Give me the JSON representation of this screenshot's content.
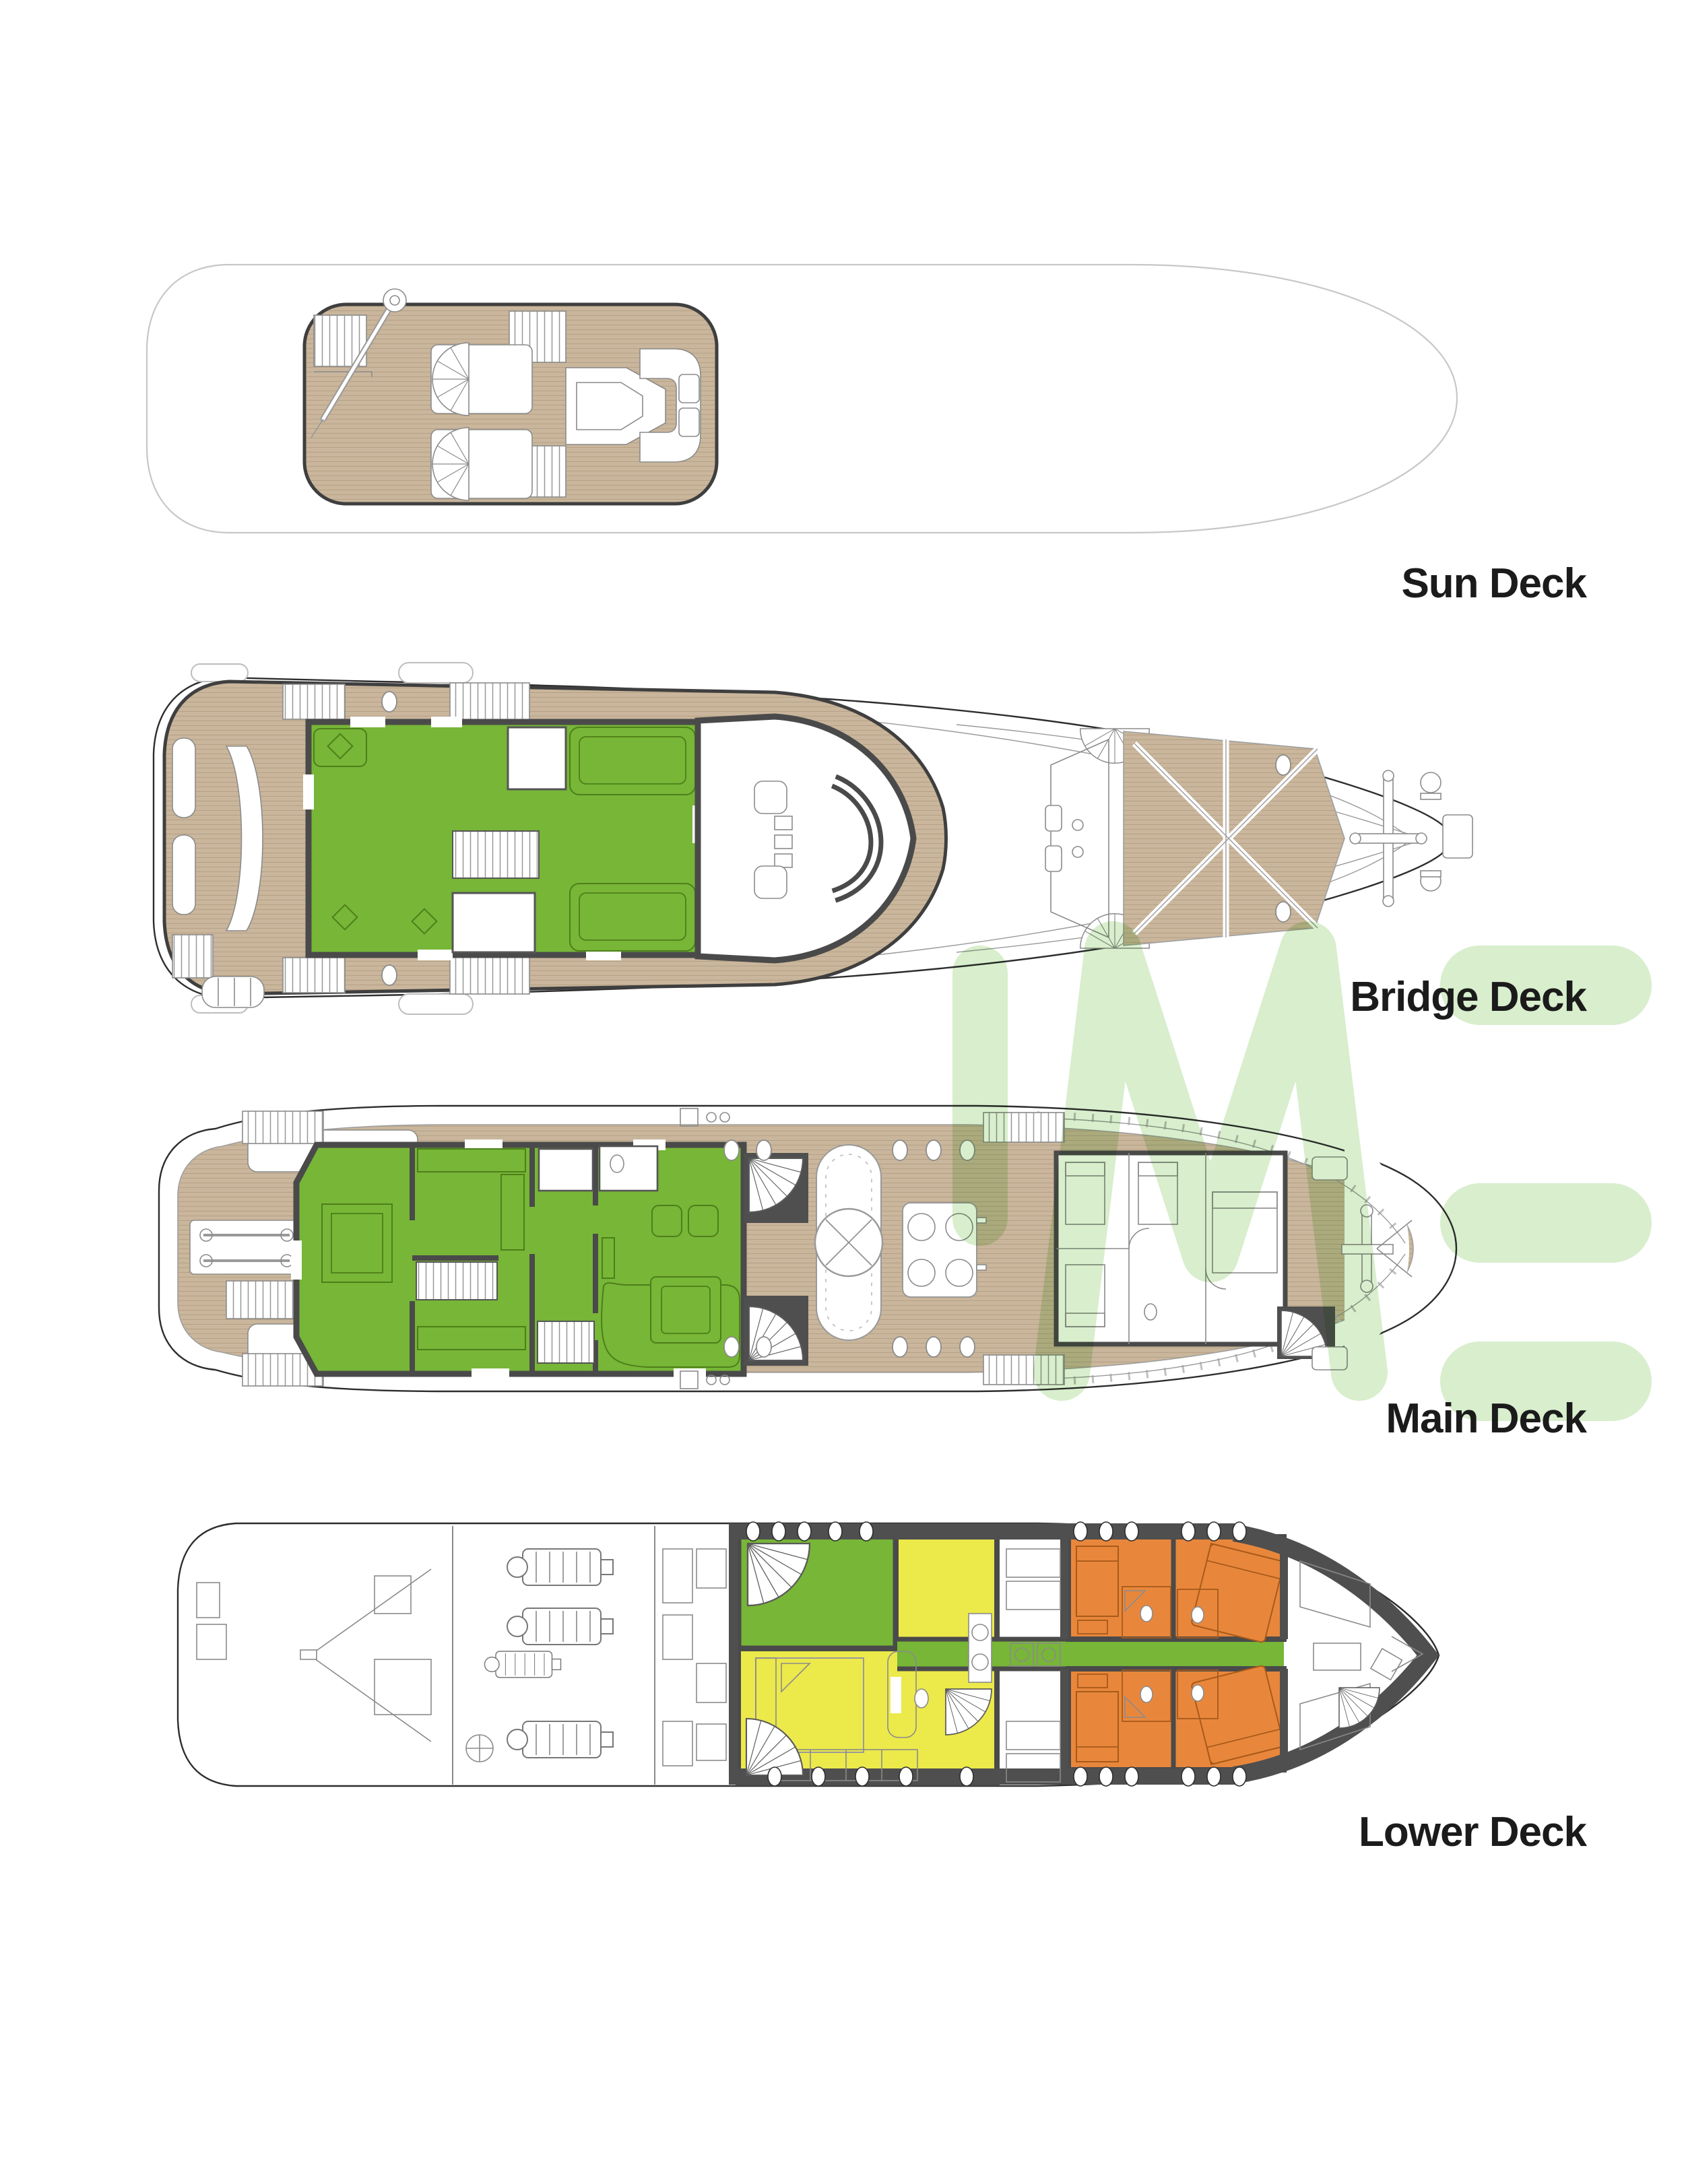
{
  "page": {
    "background": "#ffffff"
  },
  "decks": [
    {
      "id": "sun-deck",
      "label": "Sun Deck"
    },
    {
      "id": "bridge-deck",
      "label": "Bridge Deck"
    },
    {
      "id": "main-deck",
      "label": "Main Deck"
    },
    {
      "id": "lower-deck",
      "label": "Lower Deck"
    }
  ],
  "watermark": {
    "text": "IME",
    "color": "#d8eecd"
  },
  "colors": {
    "wood": "#c9b69c",
    "woodLine": "#b7a286",
    "green": "#77b637",
    "greenDark": "#4d7f1a",
    "yellow": "#ece94b",
    "orange": "#e8873c",
    "orangeDark": "#a85a19",
    "wall": "#4a4a4a",
    "darkBand": "#4f4f4f",
    "hull": "#2d2d2d",
    "hullLight": "#c7c7c7",
    "thin": "#8b8b8b",
    "label": "#1b1b1b",
    "watermark": "#d8eecd"
  }
}
